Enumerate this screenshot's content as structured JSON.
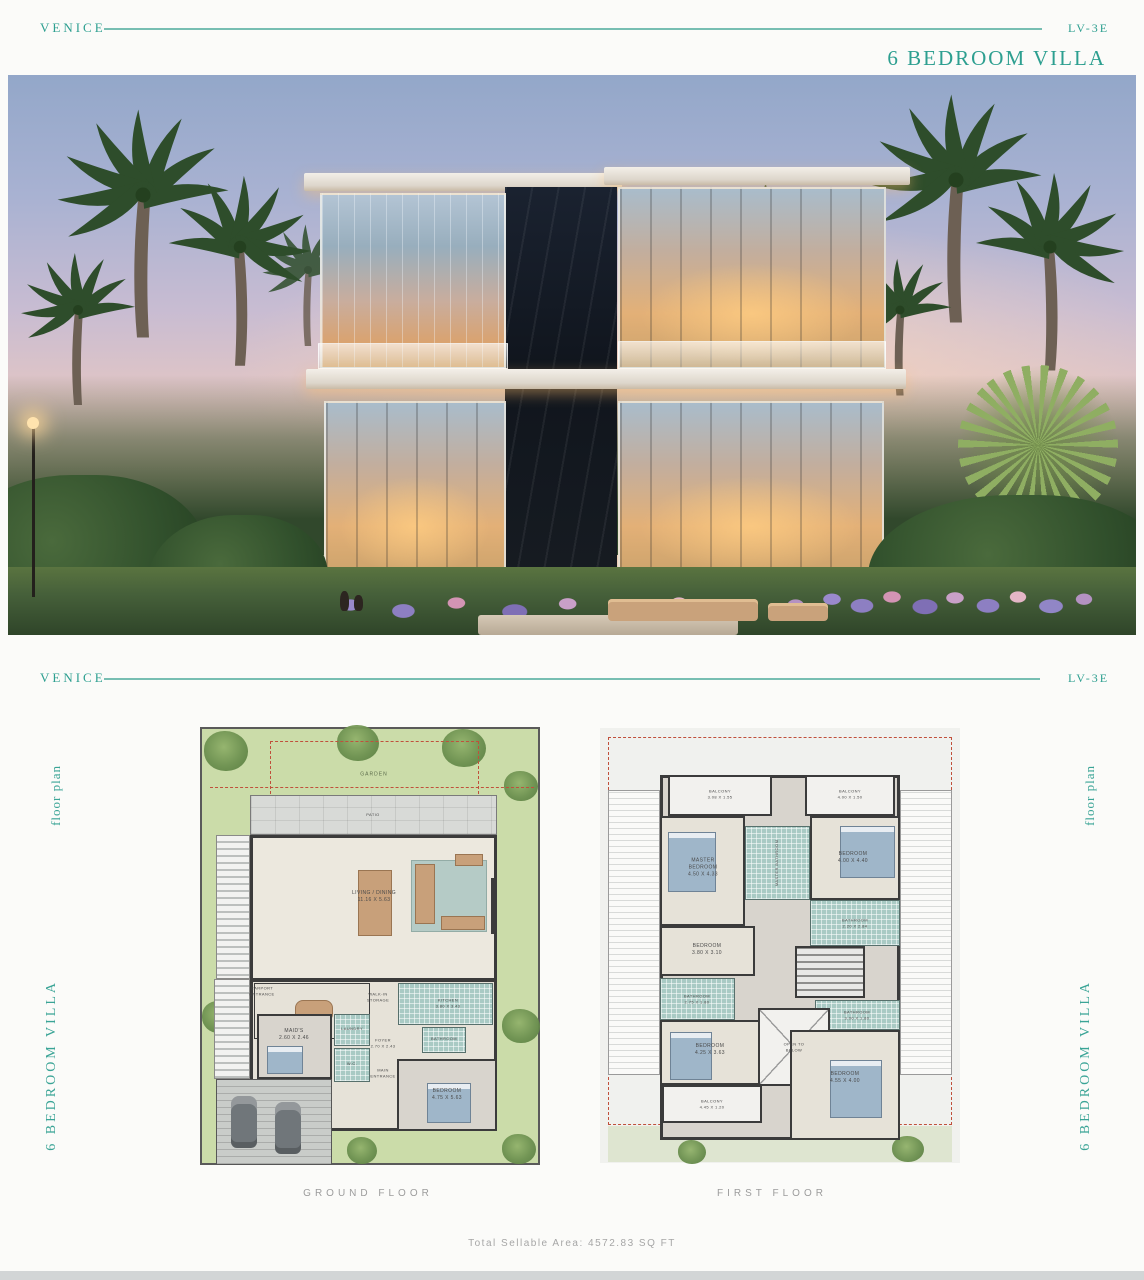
{
  "colors": {
    "accent": "#2d9f90",
    "caption_gray": "#9c9c9c",
    "plan_boundary_red": "#c0503c",
    "wet_room_teal": "#a9cac4"
  },
  "header": {
    "brand": "VENICE",
    "unit_code": "LV-3E",
    "subtitle": "6 BEDROOM VILLA"
  },
  "section_header": {
    "brand": "VENICE",
    "unit_code": "LV-3E"
  },
  "side_labels": {
    "top": "floor plan",
    "bottom": "6 BEDROOM VILLA"
  },
  "plans": {
    "ground": {
      "caption": "GROUND FLOOR",
      "rooms": {
        "garden": "GARDEN",
        "patio": "PATIO",
        "living": "LIVING / DINING\n11.16 X 5.63",
        "carport_entrance": "CARPORT\nENTRANCE",
        "maids": "MAID'S\n2.60 X 2.46",
        "laundry": "LAUNDRY",
        "wc": "W.C.",
        "foyer": "FOYER\n2.70 X 2.43",
        "main_entrance": "MAIN\nENTRANCE",
        "storage": "WALK-IN\nSTORAGE",
        "kitchen": "KITCHEN\n3.80 X 3.43",
        "bathroom": "BATHROOM",
        "bedroom": "BEDROOM\n4.75 X 5.63"
      }
    },
    "first": {
      "caption": "FIRST FLOOR",
      "rooms": {
        "balcony_tl": "BALCONY\n3.08 X 1.55",
        "balcony_tr": "BALCONY\n4.00 X 1.50",
        "master_bedroom": "MASTER\nBEDROOM\n4.50 X 4.33",
        "master_bathroom": "MASTER BATHROOM",
        "bedroom_tr": "BEDROOM\n4.00 X 4.40",
        "bathroom_r": "BATHROOM\n2.20 X 2.84",
        "bedroom_ml": "BEDROOM\n3.80 X 3.10",
        "bathroom_l": "BATHROOM\n2.75 X 1.80",
        "open_below": "OPEN TO\nBELOW",
        "bathroom_mr": "BATHROOM\n3.00 X 1.80",
        "bedroom_bl": "BEDROOM\n4.25 X 3.63",
        "bedroom_br": "BEDROOM\n4.55 X 4.00",
        "balcony_b": "BALCONY\n4.45 X 1.20"
      }
    }
  },
  "footer": {
    "total_area": "Total Sellable Area: 4572.83 SQ FT"
  }
}
